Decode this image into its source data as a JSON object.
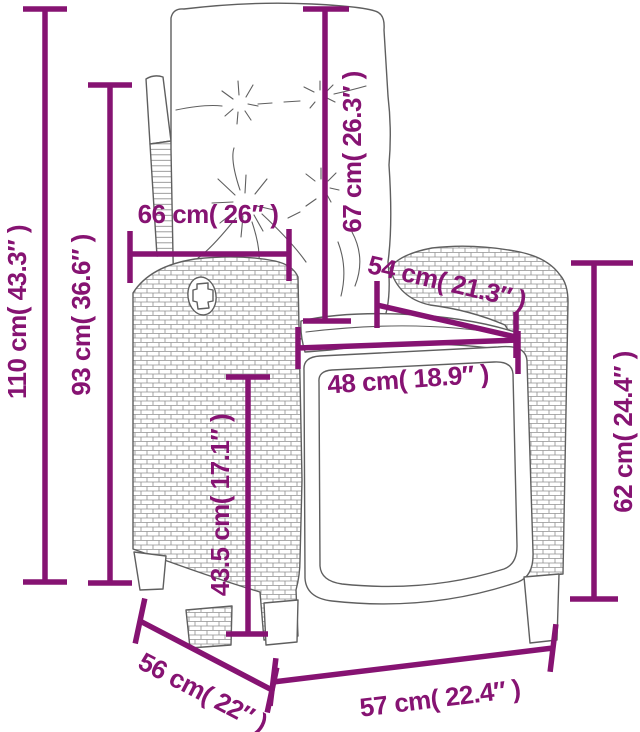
{
  "diagram": {
    "type": "product-dimension-diagram",
    "subject": "reclining wicker garden chair with cushions",
    "accent_color": "#861372",
    "sketch_color": "#5f5f5f",
    "background_color": "#ffffff",
    "dims": {
      "overall_height": {
        "label": "110 cm( 43.3″ )",
        "cm": 110,
        "in": 43.3
      },
      "back_height": {
        "label": "93 cm( 36.6″ )",
        "cm": 93,
        "in": 36.6
      },
      "back_width": {
        "label": "66 cm( 26″ )",
        "cm": 66,
        "in": 26
      },
      "back_length": {
        "label": "67 cm( 26.3″ )",
        "cm": 67,
        "in": 26.3
      },
      "armrest_length": {
        "label": "54 cm( 21.3″ )",
        "cm": 54,
        "in": 21.3
      },
      "seat_width": {
        "label": "48 cm( 18.9″ )",
        "cm": 48,
        "in": 18.9
      },
      "seat_height": {
        "label": "43.5 cm( 17.1″ )",
        "cm": 43.5,
        "in": 17.1
      },
      "armrest_height": {
        "label": "62 cm( 24.4″ )",
        "cm": 62,
        "in": 24.4
      },
      "side_depth": {
        "label": "56 cm( 22″ )",
        "cm": 56,
        "in": 22
      },
      "front_width": {
        "label": "57 cm( 22.4″ )",
        "cm": 57,
        "in": 22.4
      }
    }
  }
}
